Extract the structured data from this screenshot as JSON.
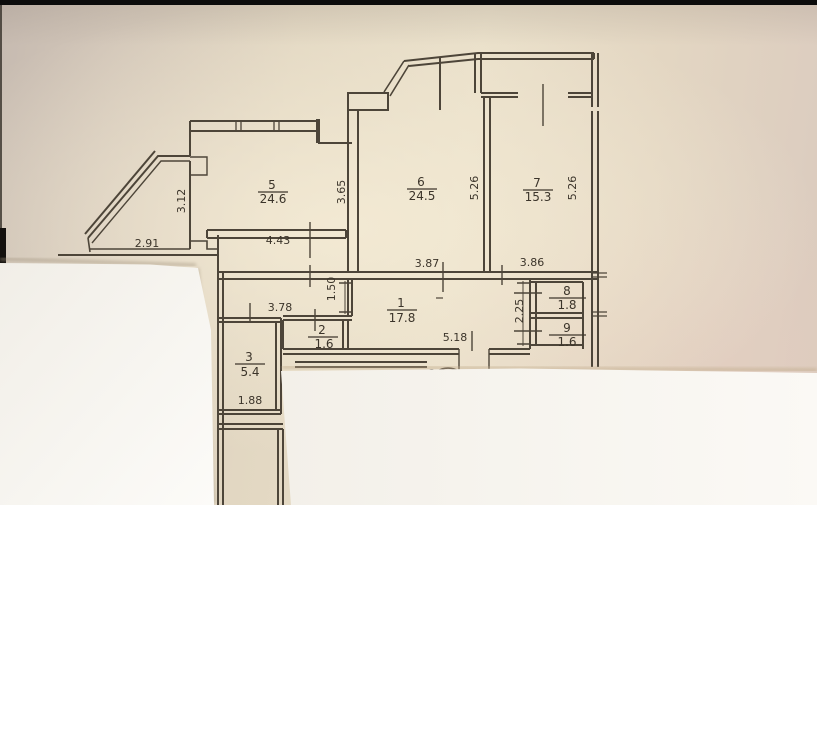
{
  "floor_plan": {
    "rooms": [
      {
        "number": "1",
        "area": "17.8"
      },
      {
        "number": "2",
        "area": "1.6"
      },
      {
        "number": "3",
        "area": "5.4"
      },
      {
        "number": "5",
        "area": "24.6"
      },
      {
        "number": "6",
        "area": "24.5"
      },
      {
        "number": "7",
        "area": "15.3"
      },
      {
        "number": "8",
        "area": "1.8"
      },
      {
        "number": "9",
        "area": "1.6"
      }
    ],
    "dimensions": [
      {
        "value": "3.12"
      },
      {
        "value": "2.91"
      },
      {
        "value": "4.43"
      },
      {
        "value": "3.65"
      },
      {
        "value": "5.26"
      },
      {
        "value": "5.26"
      },
      {
        "value": "3.87"
      },
      {
        "value": "3.86"
      },
      {
        "value": "1.50"
      },
      {
        "value": "3.78"
      },
      {
        "value": "2.25"
      },
      {
        "value": "5.18"
      },
      {
        "value": "1.88"
      }
    ],
    "partial_label": "3",
    "colors": {
      "paper_beige": "#e8dfc9",
      "ink": "#4d4539",
      "overlay_paper": "#f7f5f0",
      "black_bar": "#0c0c0c",
      "page_background": "#ffffff"
    }
  }
}
